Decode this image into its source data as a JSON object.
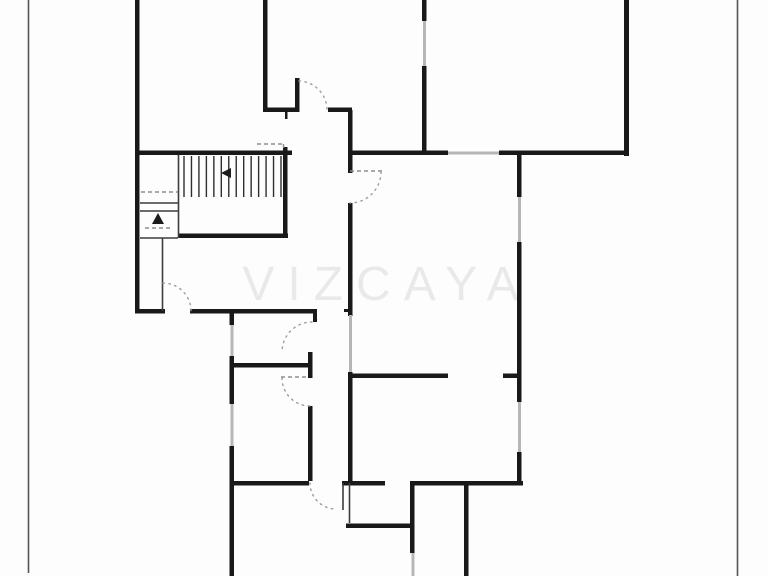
{
  "watermark": {
    "text": "VIZCAYA"
  },
  "plan": {
    "canvas": {
      "width": 768,
      "height": 576,
      "background": "#fdfdfd"
    },
    "colors": {
      "wall": "#191919",
      "window": "#b6b6b6",
      "thin": "#3d3d3d",
      "dashed": "#8f8f8f",
      "arc": "#9c9c9c",
      "tread": "#2e2e2e",
      "page_border": "#555555",
      "arrow": "#1c1c1c"
    },
    "page_borders": [
      [
        28.5,
        0,
        28.5,
        573
      ],
      [
        737.5,
        0,
        737.5,
        576
      ]
    ],
    "walls": [
      [
        135,
        0,
        4.5,
        313
      ],
      [
        135,
        309,
        30,
        4.5
      ],
      [
        190,
        309,
        127,
        4.5
      ],
      [
        313,
        309,
        4,
        13
      ],
      [
        229.5,
        313,
        4.5,
        12
      ],
      [
        229.5,
        356,
        4.5,
        48
      ],
      [
        229.5,
        446,
        4.5,
        130
      ],
      [
        231,
        363,
        79,
        4.5
      ],
      [
        308,
        352,
        4.5,
        26
      ],
      [
        308,
        406,
        4.5,
        75
      ],
      [
        231,
        481,
        78,
        4.5
      ],
      [
        342,
        481,
        43,
        4.5
      ],
      [
        411,
        481,
        112,
        4.5
      ],
      [
        346,
        523.5,
        67,
        4.5
      ],
      [
        410,
        481,
        4.5,
        72
      ],
      [
        464,
        485,
        4.5,
        91
      ],
      [
        263,
        0,
        4.5,
        110
      ],
      [
        263,
        107.5,
        35,
        4.5
      ],
      [
        295,
        78,
        4.5,
        34
      ],
      [
        328,
        107.5,
        24,
        4.5
      ],
      [
        348,
        110,
        4.5,
        63
      ],
      [
        348,
        203,
        4.5,
        113
      ],
      [
        348,
        372,
        4.5,
        111
      ],
      [
        350,
        373.5,
        98,
        4.5
      ],
      [
        503,
        373.5,
        16,
        4.5
      ],
      [
        517,
        155,
        4.5,
        42
      ],
      [
        517,
        242,
        4.5,
        160
      ],
      [
        517,
        452,
        4.5,
        31
      ],
      [
        624,
        0,
        5,
        156
      ],
      [
        499,
        150.5,
        128,
        4.5
      ],
      [
        348,
        150.5,
        100,
        4.5
      ],
      [
        422,
        0,
        4.5,
        21
      ],
      [
        422,
        66,
        4.5,
        86
      ],
      [
        135,
        150.5,
        157,
        4.5
      ],
      [
        283,
        147,
        4.5,
        91
      ],
      [
        178,
        233.5,
        110,
        4.5
      ],
      [
        344,
        309,
        4,
        3
      ],
      [
        285,
        112,
        2.5,
        7
      ]
    ],
    "windows": [
      [
        230.5,
        325,
        3,
        31
      ],
      [
        230.5,
        404,
        3,
        42
      ],
      [
        349,
        315,
        3,
        57
      ],
      [
        518,
        197,
        3,
        45
      ],
      [
        518,
        402,
        3,
        50
      ],
      [
        448,
        151.5,
        51,
        3
      ],
      [
        423,
        21,
        3,
        45
      ],
      [
        411.5,
        553,
        3,
        23
      ]
    ],
    "thin_lines": [
      [
        162.5,
        238,
        162.5,
        311
      ],
      [
        178.5,
        155,
        178.5,
        238
      ],
      [
        140,
        203,
        178,
        203
      ],
      [
        140,
        211,
        178,
        211
      ],
      [
        140,
        238,
        178,
        238
      ],
      [
        343,
        483,
        343,
        510
      ],
      [
        349.5,
        483,
        349.5,
        523
      ]
    ],
    "dashed_lines": [
      [
        350,
        171,
        382,
        171
      ],
      [
        281,
        377,
        308,
        377
      ],
      [
        257,
        144,
        284,
        144
      ],
      [
        283.5,
        144,
        283.5,
        151
      ],
      [
        141,
        192,
        178,
        192
      ],
      [
        145,
        228,
        170,
        228
      ]
    ],
    "door_arcs": [
      "M163,283 A28,28 0 0 1 191,311",
      "M299,81 A29,29 0 0 1 327,110",
      "M381,172 A31,31 0 0 1 350,203",
      "M312,322 A30,30 0 0 0 282,352",
      "M282,378 A28,28 0 0 0 310,406",
      "M310,483 A26,26 0 0 0 336,509"
    ],
    "stairs": {
      "tread_x_start": 184,
      "tread_x_end": 281,
      "tread_count": 14,
      "tread_y_top": 156,
      "tread_y_bottom": 197
    },
    "arrows": [
      [
        158,
        213,
        152,
        224,
        164,
        224
      ],
      [
        221,
        173,
        231,
        168,
        231,
        178
      ]
    ],
    "watermark_pos": {
      "x": 387,
      "y": 300
    }
  }
}
